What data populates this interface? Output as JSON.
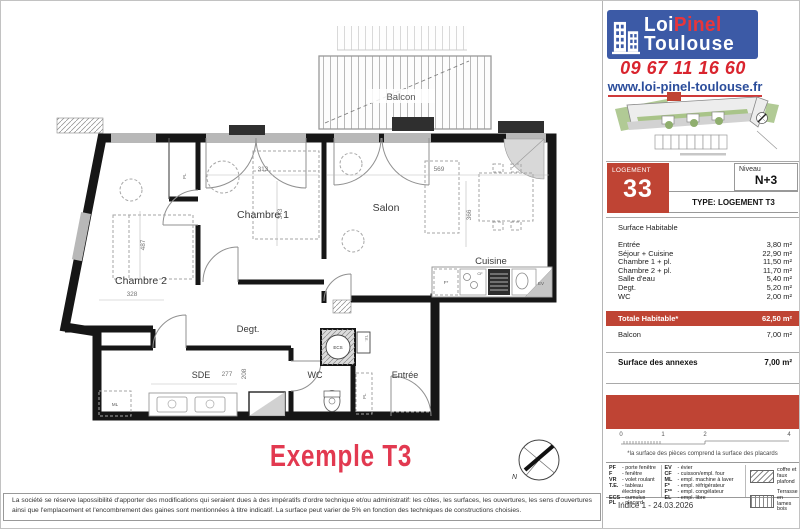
{
  "brand": {
    "logo_line1_left": "Loi",
    "logo_line1_right": "Pinel",
    "logo_line2": "Toulouse",
    "phone": "09 67 11 16 60",
    "website": "www.loi-pinel-toulouse.fr",
    "logo_bg": "#3c5aa6",
    "accent_red": "#bf4434"
  },
  "unit": {
    "label": "LOGEMENT",
    "number": "33",
    "level_label": "Niveau",
    "level_value": "N+3",
    "type_row": "TYPE:  LOGEMENT T3"
  },
  "surfaces": {
    "section_title": "Surface Habitable",
    "rooms": [
      {
        "name": "Entrée",
        "area": "3,80 m²"
      },
      {
        "name": "Séjour + Cuisine",
        "area": "22,90 m²"
      },
      {
        "name": "Chambre 1 + pl.",
        "area": "11,50 m²"
      },
      {
        "name": "Chambre 2 + pl.",
        "area": "11,70 m²"
      },
      {
        "name": "Salle d'eau",
        "area": "5,40 m²"
      },
      {
        "name": "Degt.",
        "area": "5,20 m²"
      },
      {
        "name": "WC",
        "area": "2,00 m²"
      }
    ],
    "total_label": "Totale Habitable*",
    "total_value": "62,50 m²",
    "balcony_label": "Balcon",
    "balcony_value": "7,00 m²",
    "annex_label": "Surface des annexes",
    "annex_value": "7,00 m²"
  },
  "scale_bar": {
    "t0": "0",
    "t1": "1",
    "t2": "2",
    "t4": "4"
  },
  "footnote": "*la surface des pièces comprend la surface des placards",
  "legend": {
    "col1": [
      {
        "abbr": "PF",
        "label": "- porte fenêtre"
      },
      {
        "abbr": "F",
        "label": "- fenêtre"
      },
      {
        "abbr": "VR",
        "label": "- volet roulant"
      },
      {
        "abbr": "T.E.",
        "label": "- tableau électrique"
      },
      {
        "abbr": "ECS",
        "label": "- cumulus"
      },
      {
        "abbr": "PL",
        "label": "- placard"
      }
    ],
    "col2": [
      {
        "abbr": "EV",
        "label": "- évier"
      },
      {
        "abbr": "CF",
        "label": "- cuisson/empl. four"
      },
      {
        "abbr": "ML",
        "label": "- empl. machine à laver"
      },
      {
        "abbr": "F*",
        "label": "- empl. réfrigérateur"
      },
      {
        "abbr": "F**",
        "label": "- empl. congélateur"
      },
      {
        "abbr": "EL",
        "label": "- empl. libre"
      }
    ],
    "col3": [
      {
        "swatch": "hatch",
        "label": "coffre et faux plafond"
      },
      {
        "swatch": "stripes",
        "label": "Terrasse en lames bois"
      }
    ]
  },
  "revision": "Indice 1 - 24.03.2026",
  "disclaimer": "La société se réserve lapossibilité d'apporter des modifications qui seraient dues à des impératifs d'ordre technique et/ou administratif: les côtes, les surfaces, les ouvertures, les sens d'ouvertures ainsi que l'emplacement et l'encombrement des gaines sont mentionnées à titre indicatif. La surface peut varier de 5% en fonction des techniques de constructions choisies.",
  "plan": {
    "title": "Exemple T3",
    "rooms": {
      "balcon": "Balcon",
      "chambre1": "Chambre 1",
      "chambre2": "Chambre 2",
      "salon": "Salon",
      "cuisine": "Cuisine",
      "degt": "Degt.",
      "sde": "SDE",
      "wc": "WC",
      "entree": "Entrée"
    },
    "dims": {
      "chambre1_w": "313",
      "chambre1_h": "343",
      "salon_w": "569",
      "salon_h": "366",
      "chambre2_h": "487",
      "chambre2_w": "328",
      "sde_w": "277",
      "sde_h": "208"
    },
    "equipment": {
      "ecs": "ECS",
      "te": "T.E.",
      "pl": "PL",
      "ml": "ML",
      "ev": "EV",
      "cf": "CF",
      "fridge": "F*"
    },
    "compass": "N"
  }
}
